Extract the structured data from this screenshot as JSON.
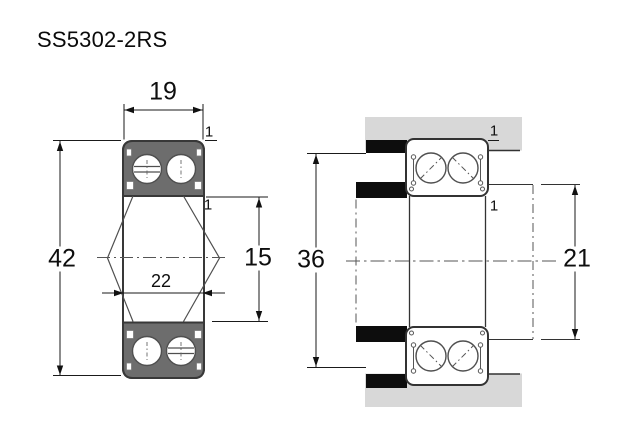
{
  "title": "SS5302-2RS",
  "views": {
    "cross_section": {
      "label": "bearing cross-section view",
      "dims": {
        "width": "19",
        "outer_diameter": "42",
        "bore_diameter": "15",
        "inner_ring_od": "22",
        "chamfer_outer": "1",
        "chamfer_inner": "1"
      }
    },
    "mounting": {
      "label": "bearing mounting-fit view",
      "dims": {
        "housing_abutment": "36",
        "shaft_abutment": "21",
        "chamfer_outer": "1",
        "chamfer_inner": "1"
      }
    }
  },
  "colors": {
    "ring_fill": "#6d6d6d",
    "housing_fill": "#d8d8d8",
    "shoulder_fill": "#0d0d0d",
    "line": "#383838",
    "background": "#ffffff"
  }
}
